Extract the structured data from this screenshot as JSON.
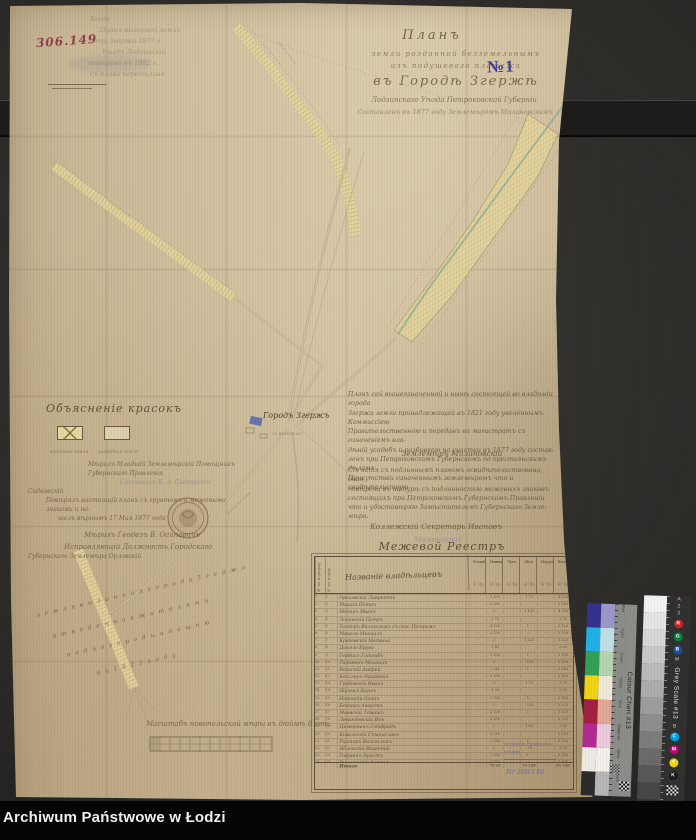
{
  "archive_bar": {
    "label": "Archiwum Państwowe w Łodzi"
  },
  "marks": {
    "catalog_number": "306.149",
    "case_number": "№1",
    "blue_stamp_lines": [
      "Archiwum Państwowe",
      "w Łodzi"
    ],
    "blue_stamp_note": "Nr 306/149"
  },
  "title_block": {
    "l1": "Планъ",
    "l2": "земли розданной безземельнымъ",
    "l3": "изъ подушеваго платежа",
    "l4": "въ Городѣ Згержѣ",
    "l5": "Лодзинскаго Уѣзда Петроковской Губерніи",
    "l6": "Составленъ въ 1877 году Землемѣромъ Милановскимъ"
  },
  "pencil_notes": [
    "Копія",
    "Планъ выгонной земли",
    "гор. Згержа 1877 г.",
    "Уѣздъ Лодзинскій",
    "повѣрено въ 1882 г.",
    "съ плана передѣлано"
  ],
  "legend": {
    "heading": "Объясненіе красокъ",
    "swatch1_caption": "выгонная земля",
    "swatch2_caption": "усадебная земля",
    "notes": [
      "Мѣрилъ Младшій Землемѣрскій Помощникъ Губернскаго Правленія",
      "Составилъ К. А. Садковскій",
      "Садковскій",
      "Повѣрялъ настоящій планъ съ грунтомъ и межевыми знаками и на-",
      "шелъ вѣрнымъ 17 Мая 1877 года",
      "Мѣрилъ Геодезъ В. Осиповичъ",
      "Исправляющій Должность Городскаго",
      "Губернскаго Землемѣра Орловскій"
    ]
  },
  "certification": {
    "para1": [
      "Планъ сей вышеозначенной и нынѣ состоящей во владѣніи города",
      "Згержа земли принадлежащей въ 1821 году уволеннымъ Коммиссіею",
      "Правительственною и переданъ въ магистратъ съ означеніемъ вла-",
      "дѣній усадебъ и разбивкою на участки въ 1877 году состав-",
      "ленъ при Петроковскомъ Губернскомъ по крестьянскимъ дѣламъ",
      "Присутствіи означеннымъ землемѣромъ что и свидѣтельствую"
    ],
    "sig1": "Землемѣръ Милановскій",
    "para2": [
      "Сія копія съ подлиннымъ планомъ освидѣтельствована, оная",
      "повѣрена въ натурѣ съ подлинностью межевыхъ знаковъ",
      "состоящихъ при Петроковскомъ Губернскомъ Правленіи",
      "что и удостовѣряю Замѣстителемъ Губернскаго Земле-",
      "мѣра."
    ],
    "sig2": "Коллежскій Секретарь Ивановъ",
    "sig3": "Милановскій"
  },
  "map_labels": {
    "city": "Городъ Згержъ",
    "city_sub": "съ выгонами",
    "road1": "Дорога изъ Озоркова",
    "road2": "Дорога изъ Ленчицы",
    "road3": "Дорога въ Александровъ"
  },
  "diagonal_notes": [
    "з е м л я   в ы г о н н а я   г о р о д а   З г е р ж а",
    "о т в е д е н н а я   ж и т е л я м ъ",
    "п о д ъ   о г о р о д ы   и   п а ш н ю",
    "в ъ   1 8 2 1   г о д у"
  ],
  "scale": {
    "caption": "Масштабъ новопольской мѣры въ дюймѣ 8 сот."
  },
  "register": {
    "title": "Межевой Реестръ",
    "col_no1": "№ по порядку",
    "col_no2": "№ по плану",
    "name_header": "Названіе владѣльцевъ",
    "groups": [
      {
        "t": "Усадьбы",
        "s": "м · пр"
      },
      {
        "t": "Пашни",
        "s": "м · пр"
      },
      {
        "t": "Луга",
        "s": "м · пр"
      },
      {
        "t": "Лѣса",
        "s": "м · пр"
      },
      {
        "t": "Неудоб.",
        "s": "м · пр"
      },
      {
        "t": "Всего",
        "s": "м · пр"
      }
    ],
    "rows": [
      {
        "n": "1",
        "p": "1",
        "name": "Ореховскій Лаврентій",
        "v": [
          "· ·",
          "3 150",
          "· ·",
          "1 75",
          "· ·",
          "4 225"
        ]
      },
      {
        "n": "2",
        "p": "2",
        "name": "Мацкій Петръ",
        "v": [
          "· ·",
          "2 280",
          "· ·",
          "· ·",
          "· ·",
          "2 280"
        ]
      },
      {
        "n": "3",
        "p": "3",
        "name": "Мейеръ Иванъ",
        "v": [
          "· ·",
          "3 ·",
          "· ·",
          "1 150",
          "· ·",
          "4 150"
        ]
      },
      {
        "n": "4",
        "p": "4",
        "name": "Лозинскій Петръ",
        "v": [
          "· ·",
          "2 75",
          "· ·",
          "· ·",
          "· ·",
          "2 75"
        ]
      },
      {
        "n": "5",
        "p": "5",
        "name": "Теодоръ Вильгельмъ съ сын. Петромъ",
        "v": [
          "· ·",
          "4 120",
          "· ·",
          "1 ·",
          "· ·",
          "5 120"
        ]
      },
      {
        "n": "6",
        "p": "6",
        "name": "Мицель Михаилъ",
        "v": [
          "· ·",
          "3 150",
          "· ·",
          "· ·",
          "· ·",
          "3 150"
        ]
      },
      {
        "n": "7",
        "p": "7",
        "name": "Краковскій Матвѣй",
        "v": [
          "· ·",
          "2 ·",
          "· ·",
          "1 225",
          "· ·",
          "3 225"
        ]
      },
      {
        "n": "8",
        "p": "8",
        "name": "Дысель Бруно",
        "v": [
          "· ·",
          "3 60",
          "· ·",
          "· ·",
          "· ·",
          "3 60"
        ]
      },
      {
        "n": "9",
        "p": "9",
        "name": "Гербихъ Готлибъ",
        "v": [
          "· ·",
          "2 190",
          "· ·",
          "1 ·",
          "· ·",
          "3 190"
        ]
      },
      {
        "n": "10",
        "p": "10",
        "name": "Тильманъ Михаилъ",
        "v": [
          "· ·",
          "3 ·",
          "· ·",
          "· 150",
          "· ·",
          "3 150"
        ]
      },
      {
        "n": "11",
        "p": "11",
        "name": "Вольскій Андрей",
        "v": [
          "· ·",
          "2 240",
          "· ·",
          "1 ·",
          "· ·",
          "3 240"
        ]
      },
      {
        "n": "12",
        "p": "12",
        "name": "Кесслеръ Фридрихъ",
        "v": [
          "· ·",
          "3 150",
          "· ·",
          "· ·",
          "· ·",
          "3 150"
        ]
      },
      {
        "n": "13",
        "p": "13",
        "name": "Грабовскій Иванъ",
        "v": [
          "· ·",
          "2 ·",
          "· ·",
          "1 75",
          "· ·",
          "3 75"
        ]
      },
      {
        "n": "14",
        "p": "14",
        "name": "Шульцъ Карлъ",
        "v": [
          "· ·",
          "3 90",
          "· ·",
          "· ·",
          "· ·",
          "3 90"
        ]
      },
      {
        "n": "15",
        "p": "15",
        "name": "Новицкій Осипъ",
        "v": [
          "· ·",
          "2 150",
          "· ·",
          "1 ·",
          "· ·",
          "3 150"
        ]
      },
      {
        "n": "16",
        "p": "16",
        "name": "Беккеръ Августъ",
        "v": [
          "· ·",
          "3 ·",
          "· ·",
          "· 225",
          "· ·",
          "3 225"
        ]
      },
      {
        "n": "17",
        "p": "17",
        "name": "Маевскій Томашъ",
        "v": [
          "· ·",
          "2 120",
          "· ·",
          "1 ·",
          "· ·",
          "3 120"
        ]
      },
      {
        "n": "18",
        "p": "18",
        "name": "Левандовскій Янъ",
        "v": [
          "· ·",
          "3 150",
          "· ·",
          "· ·",
          "· ·",
          "3 150"
        ]
      },
      {
        "n": "19",
        "p": "19",
        "name": "Цимерманъ Готфридъ",
        "v": [
          "· ·",
          "2 ·",
          "· ·",
          "1 60",
          "· ·",
          "3 60"
        ]
      },
      {
        "n": "20",
        "p": "20",
        "name": "Ковальскій Станиславъ",
        "v": [
          "· ·",
          "3 210",
          "· ·",
          "· ·",
          "· ·",
          "3 210"
        ]
      },
      {
        "n": "21",
        "p": "21",
        "name": "Рихтеръ Вильгельмъ",
        "v": [
          "· ·",
          "2 150",
          "· ·",
          "1 ·",
          "· ·",
          "3 150"
        ]
      },
      {
        "n": "22",
        "p": "22",
        "name": "Яблонскій Викентій",
        "v": [
          "· ·",
          "3 ·",
          "· ·",
          "· 75",
          "· ·",
          "3 75"
        ]
      },
      {
        "n": "23",
        "p": "23",
        "name": "Гофманъ Эрнстъ",
        "v": [
          "· ·",
          "2 180",
          "· ·",
          "1 ·",
          "· ·",
          "3 180"
        ]
      },
      {
        "n": "24",
        "p": "24",
        "name": "Вишневскій Антонъ",
        "v": [
          "· ·",
          "3 150",
          "· ·",
          "· ·",
          "· ·",
          "3 150"
        ]
      },
      {
        "n": "25",
        "p": "25",
        "name": "Крамеръ Людвигъ",
        "v": [
          "· ·",
          "2 ·",
          "· ·",
          "1 120",
          "· ·",
          "3 120"
        ]
      },
      {
        "n": "26",
        "p": "26",
        "name": "Залевскій Фома",
        "v": [
          "· ·",
          "3 75",
          "· ·",
          "· ·",
          "· ·",
          "3 75"
        ]
      },
      {
        "n": "27",
        "p": "27",
        "name": "Пашковскій Юзефъ",
        "v": [
          "· ·",
          "2 150",
          "· ·",
          "1 ·",
          "· ·",
          "3 150"
        ]
      }
    ],
    "total": {
      "label": "Итого",
      "v": [
        "· ·",
        "76 25",
        "· ·",
        "14 120",
        "· ·",
        "91 145"
      ]
    }
  },
  "color_targets": {
    "grey": {
      "label": "Grey Scale #13",
      "steps": [
        "#f4f3f1",
        "#e6e5e3",
        "#d8d7d5",
        "#cac9c7",
        "#bcbbb9",
        "#adacaa",
        "#9e9d9b",
        "#8f8e8c",
        "#7d7c7a",
        "#6b6a68",
        "#595856",
        "#474645",
        "#343433",
        "#222221"
      ],
      "marks_top": [
        "A",
        "2",
        "3"
      ],
      "marks_mid": [
        "M"
      ],
      "marks_low": [
        "B"
      ],
      "rgb": [
        {
          "t": "R",
          "c": "#c0272d"
        },
        {
          "t": "G",
          "c": "#00843d"
        },
        {
          "t": "B",
          "c": "#1d4f9f"
        }
      ],
      "cmyk": [
        {
          "t": "C",
          "c": "#00a0dc"
        },
        {
          "t": "M",
          "c": "#c5007c"
        },
        {
          "t": "Y",
          "c": "#f2d30e"
        },
        {
          "t": "K",
          "c": "#1a1a1a"
        }
      ]
    },
    "chart": {
      "label": "Colour Chart #13",
      "colors": [
        "#35308e",
        "#21b0e3",
        "#349f56",
        "#f0d312",
        "#a02040",
        "#b02a91",
        "#edeae3",
        "#2b2b2b"
      ],
      "pastels": [
        "#9b98c7",
        "#c0dfe7",
        "#b6d4b0",
        "#efe9d7",
        "#e2a795",
        "#eacada",
        "#f3f1eb",
        "#b6b6b4"
      ],
      "names": [
        "Blue",
        "Cyan",
        "Green",
        "Yellow",
        "Red",
        "Magenta",
        "White",
        "Black"
      ]
    }
  }
}
